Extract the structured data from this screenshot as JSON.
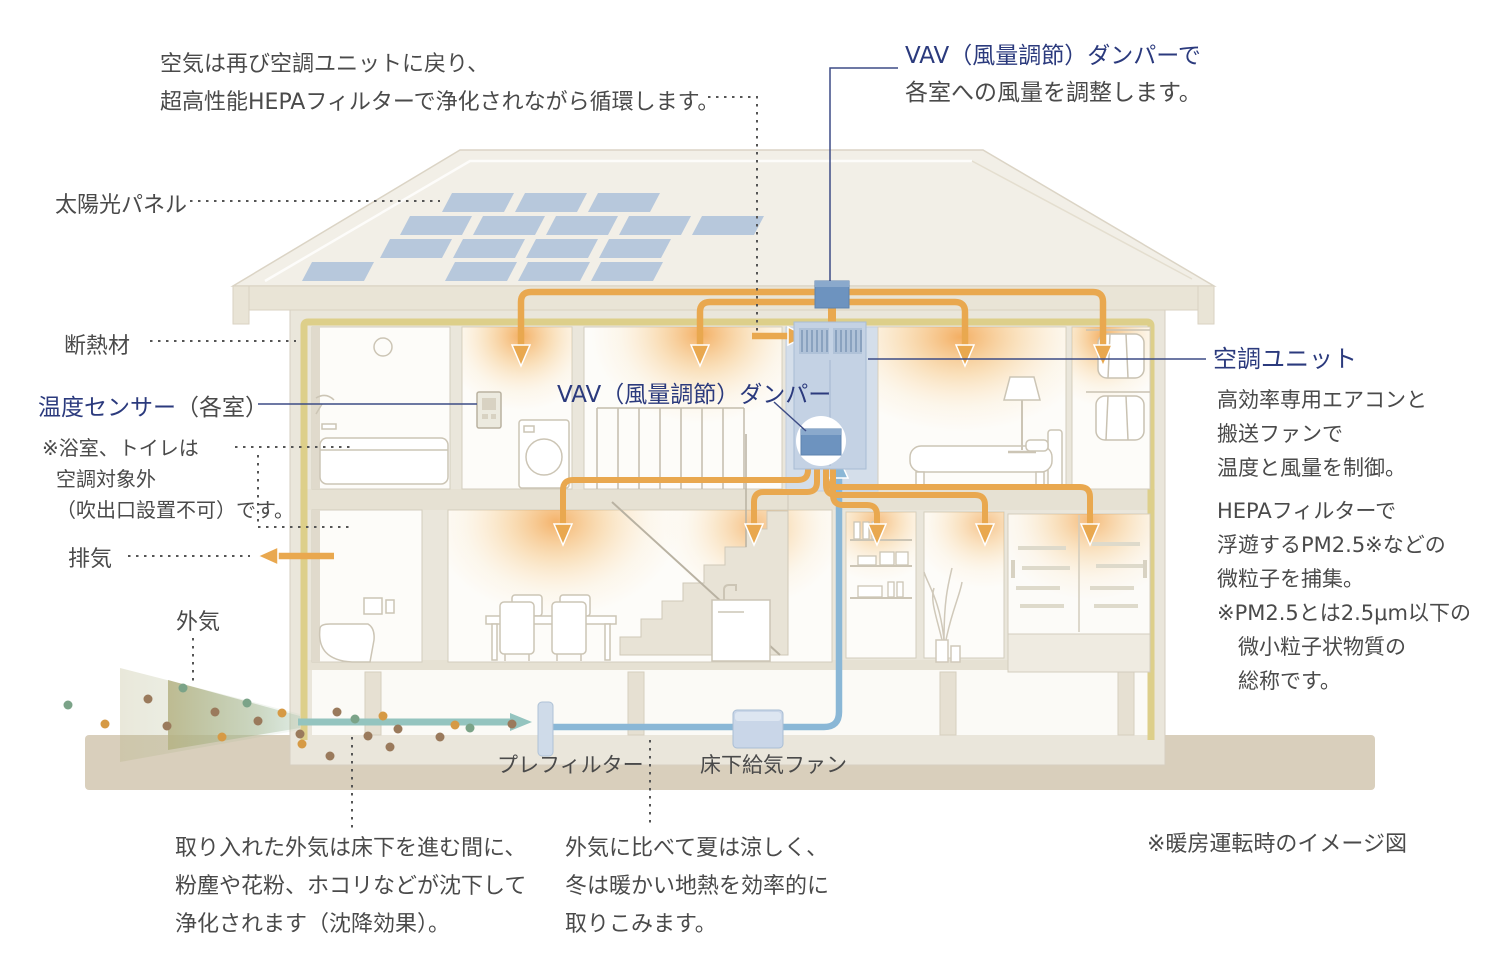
{
  "colors": {
    "navy_text": "#2b3a7d",
    "gray_text": "#4a4a4a",
    "duct_orange": "#e9a84f",
    "fresh_air_blue": "#8ab7d6",
    "insulation_yellow": "#ddcf8a",
    "damper_blue": "#6d93bf",
    "ground_beige": "#d9cfbc"
  },
  "labels": {
    "recirculation_note": {
      "line1": "空気は再び空調ユニットに戻り、",
      "line2": "超高性能HEPAフィルターで浄化されながら循環します。"
    },
    "vav_top": {
      "line1": "VAV（風量調節）ダンパーで",
      "line2": "各室への風量を調整します。"
    },
    "solar_panel": "太陽光パネル",
    "insulation": "断熱材",
    "temp_sensor": {
      "main": "温度センサー",
      "suffix": "（各室）"
    },
    "bath_note": {
      "line1": "※浴室、トイレは",
      "line2": "空調対象外",
      "line3": "（吹出口設置不可）です。"
    },
    "exhaust": "排気",
    "outside_air": "外気",
    "vav_mid": "VAV（風量調節）ダンパー",
    "ac_unit": {
      "title": "空調ユニット",
      "desc1_line1": "高効率専用エアコンと",
      "desc1_line2": "搬送ファンで",
      "desc1_line3": "温度と風量を制御。",
      "desc2_line1": "HEPAフィルターで",
      "desc2_line2": "浮遊するPM2.5※などの",
      "desc2_line3": "微粒子を捕集。",
      "note_line1": "※PM2.5とは2.5μm以下の",
      "note_line2": "微小粒子状物質の",
      "note_line3": "総称です。"
    },
    "prefilter": "プレフィルター",
    "underfloor_fan": "床下給気ファン",
    "underfloor_note": {
      "line1": "取り入れた外気は床下を進む間に、",
      "line2": "粉塵や花粉、ホコリなどが沈下して",
      "line3": "浄化されます（沈降効果）。"
    },
    "geothermal_note": {
      "line1": "外気に比べて夏は涼しく、",
      "line2": "冬は暖かい地熱を効率的に",
      "line3": "取りこみます。"
    },
    "heating_note": "※暖房運転時のイメージ図"
  }
}
